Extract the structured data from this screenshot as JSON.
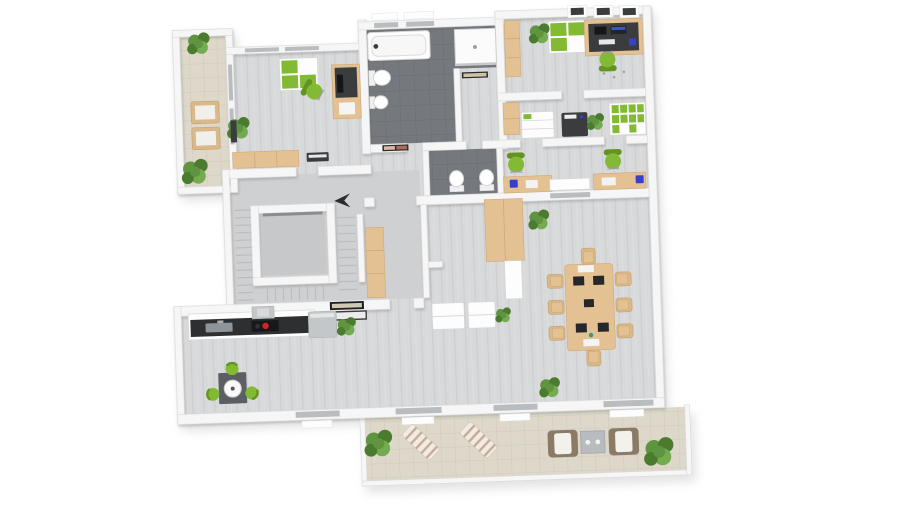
{
  "meta": {
    "title": "3D rendered floor plan, top-down view",
    "render_style": "isometric top view, white walls on white background, slight counter-clockwise tilt"
  },
  "palette": {
    "bg": "#ffffff",
    "wall": "#f6f6f6",
    "wall_edge": "#d9d9d9",
    "floor": "#d8d9da",
    "floor_streak": "#cdced0",
    "stair_floor": "#cfd0d2",
    "tile_dark": "#75797e",
    "tile_dark_line": "#696d72",
    "tile_beige": "#ddd8c9",
    "tile_beige_line": "#cfcaba",
    "wood": "#e3c193",
    "wood_dark": "#d9b88a",
    "green": "#83ba34",
    "green_dark": "#639422",
    "plant1": "#5f9440",
    "plant2": "#4a7b2e",
    "plant3": "#74ab4f",
    "dark": "#3b3c3e",
    "blue": "#3a3fc9",
    "red": "#e02020",
    "appliance": "#c3c7c9",
    "counter": "#2e2f31",
    "brown": "#8a7a66",
    "glass": "#b9bdc0",
    "mat": "#5b5e62",
    "shadow": "#cccccc"
  },
  "scene": {
    "rotation_deg": -2,
    "rooms": [
      {
        "id": "balcony-top-left",
        "floor": "beige-tile",
        "features": [
          "potted-plant",
          "potted-plant",
          "wooden-chair",
          "wooden-chair"
        ]
      },
      {
        "id": "office-left",
        "floor": "gray-plank",
        "features": [
          "green-white-cabinet",
          "desk-with-monitor",
          "green-office-chair",
          "potted-plant",
          "wood-sideboard",
          "keyboard-device"
        ]
      },
      {
        "id": "bathroom",
        "floor": "dark-tile",
        "features": [
          "bathtub",
          "toilet",
          "bidet",
          "shower",
          "wall-picture"
        ]
      },
      {
        "id": "office-top-right",
        "floor": "gray-plank",
        "features": [
          "wood-wardrobe",
          "green-white-cabinet",
          "desk-with-two-monitors",
          "green-office-chair",
          "potted-plant",
          "skylight",
          "skylight",
          "skylight"
        ]
      },
      {
        "id": "office-mid-right",
        "floor": "gray-plank",
        "features": [
          "wood-wardrobe",
          "low-shelf",
          "copier",
          "potted-plant",
          "binder-shelf"
        ]
      },
      {
        "id": "wc",
        "floor": "dark-tile",
        "features": [
          "toilet",
          "toilet"
        ]
      },
      {
        "id": "office-small-right",
        "floor": "gray-plank",
        "features": [
          "desk",
          "green-office-chair",
          "window-sill",
          "desk",
          "green-office-chair"
        ]
      },
      {
        "id": "corridor",
        "floor": "gray-plank",
        "features": []
      },
      {
        "id": "stairwell",
        "floor": "gray-screed",
        "features": [
          "elevator",
          "stair-flight",
          "stair-flight",
          "stair-flight",
          "direction-arrow",
          "doormat"
        ]
      },
      {
        "id": "hall-niche",
        "floor": "gray-screed",
        "features": [
          "wood-wardrobe"
        ]
      },
      {
        "id": "open-space",
        "floor": "gray-plank",
        "features": [
          "wood-wardrobe",
          "white-cabinet",
          "bench",
          "bench",
          "potted-plant",
          "conference-table",
          "conference-chairs-x8",
          "laptops-x5",
          "potted-plant",
          "potted-plant"
        ]
      },
      {
        "id": "kitchen",
        "floor": "gray-plank",
        "features": [
          "kitchen-counter",
          "sink",
          "cooktop-red-burner",
          "extractor-hood",
          "fridge",
          "wall-picture",
          "potted-plant",
          "bistro-table",
          "green-stool",
          "green-stool",
          "green-stool"
        ]
      },
      {
        "id": "terrace-bottom",
        "floor": "beige-tile",
        "features": [
          "potted-plant",
          "sun-lounger",
          "sun-lounger",
          "armchair",
          "side-table",
          "armchair",
          "potted-plant"
        ]
      }
    ],
    "counts": {
      "green_office_chairs": 6,
      "conference_chairs": 8,
      "potted_plants": 12,
      "sun_loungers": 2,
      "armchairs": 2,
      "toilets": 3
    }
  }
}
